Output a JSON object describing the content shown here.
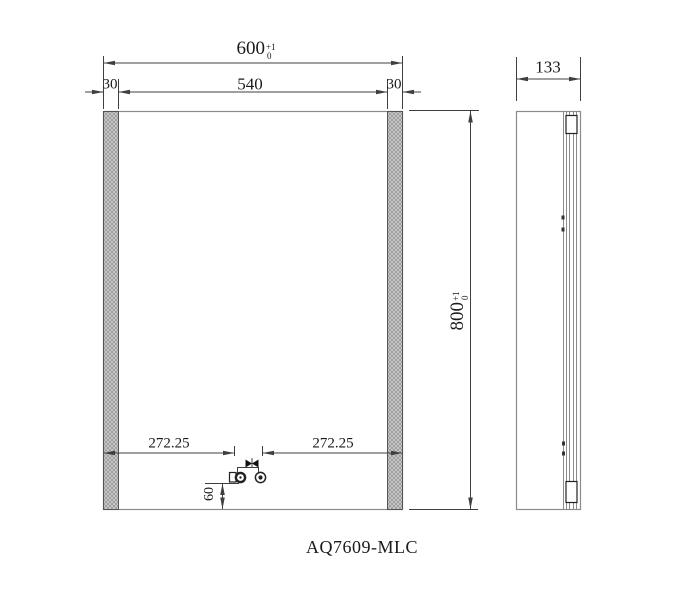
{
  "drawing": {
    "model_label": "AQ7609-MLC",
    "front_view": {
      "total_width": {
        "value": "600",
        "tol_upper": "+1",
        "tol_lower": "0"
      },
      "inner_width": "540",
      "left_margin": "30",
      "right_margin": "30",
      "height": {
        "value": "800",
        "tol_upper": "+1",
        "tol_lower": "0"
      },
      "left_center_offset": "272.25",
      "right_center_offset": "272.25",
      "fixture_bottom_offset": "60"
    },
    "side_view": {
      "depth": "133"
    },
    "colors": {
      "outline_line": "#8a8a8a",
      "dimension_line": "#3f3f3f",
      "text": "#1a1a1a",
      "hatch_fill": "#cdcdcd",
      "hatch_line": "#8f8f8f"
    }
  }
}
